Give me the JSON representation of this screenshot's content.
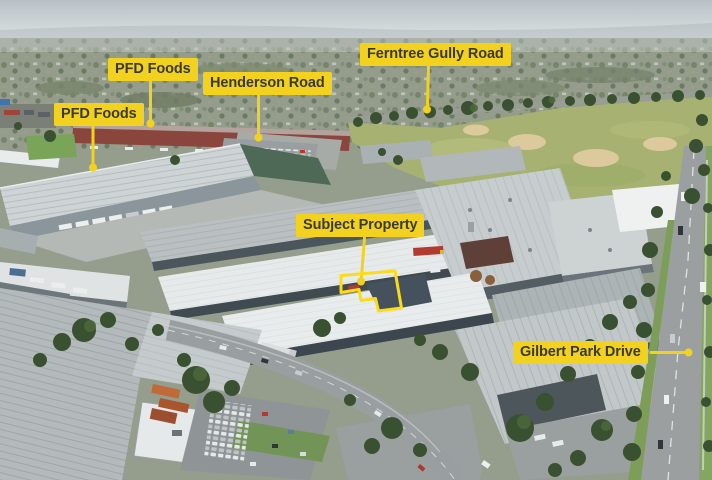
{
  "image_type": "annotated-aerial-photo",
  "annotations": {
    "labels": [
      {
        "id": "pfd-foods-upper",
        "text": "PFD Foods"
      },
      {
        "id": "pfd-foods-lower",
        "text": "PFD Foods"
      },
      {
        "id": "henderson-road",
        "text": "Henderson Road"
      },
      {
        "id": "ferntree-gully-road",
        "text": "Ferntree Gully Road"
      },
      {
        "id": "subject-property",
        "text": "Subject Property"
      },
      {
        "id": "gilbert-park-drive",
        "text": "Gilbert Park Drive"
      }
    ],
    "colors": {
      "label_bg": "#F2D21E",
      "label_text": "#3A3A33",
      "pointer": "#F2D21E",
      "outline": "#FBDC19"
    }
  }
}
